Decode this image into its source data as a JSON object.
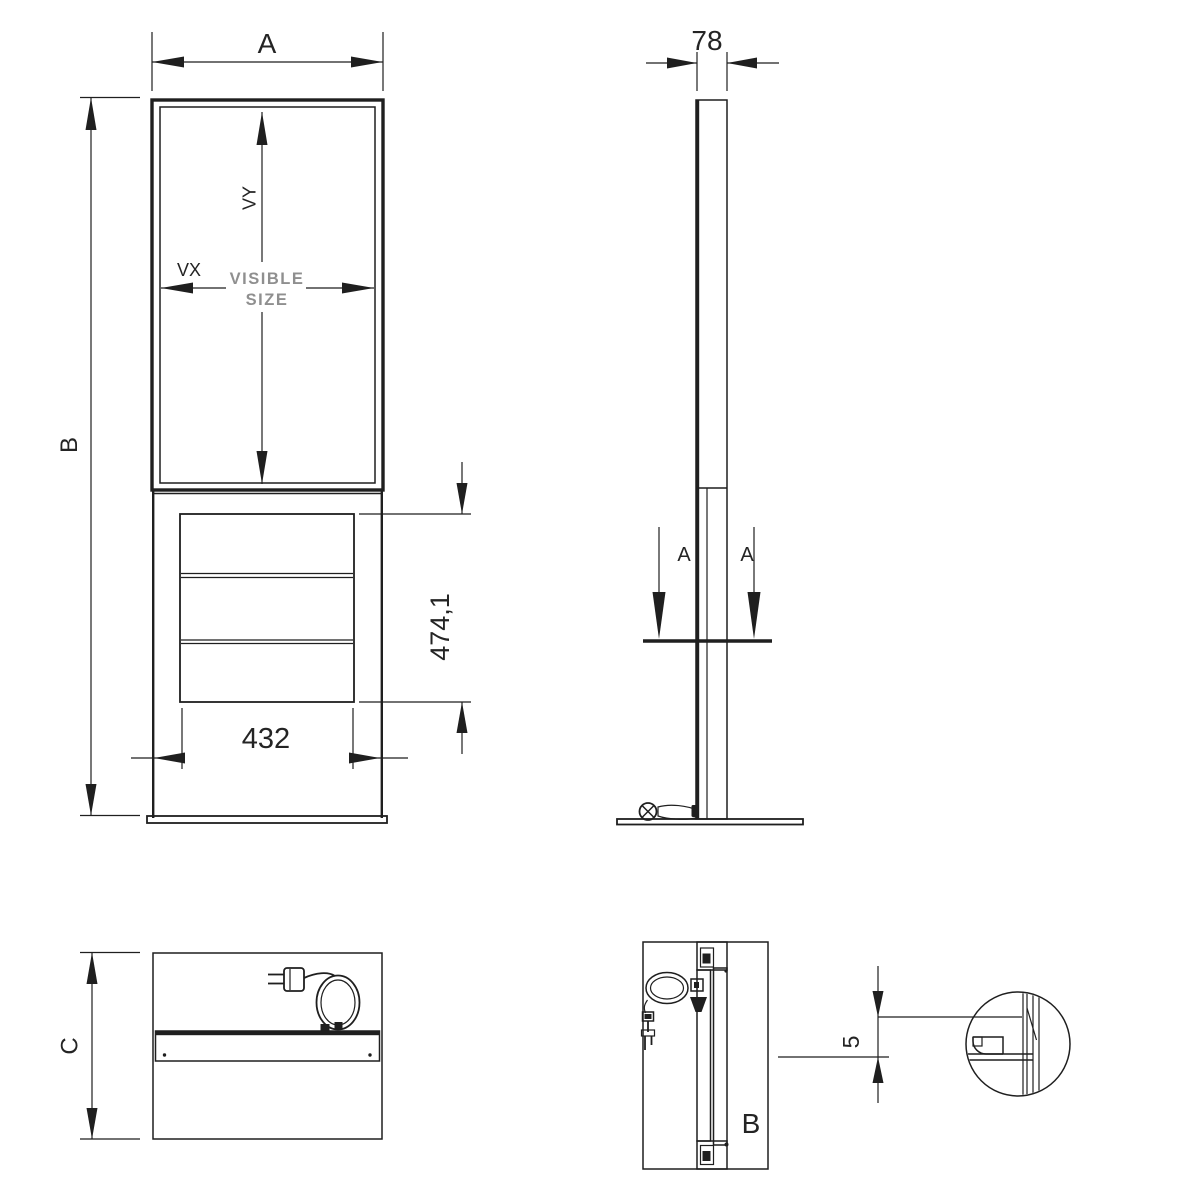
{
  "front_view": {
    "width_label": "A",
    "height_label": "B",
    "visible_height_label": "VY",
    "visible_width_label": "VX",
    "visible_size_text_line1": "VISIBLE",
    "visible_size_text_line2": "SIZE",
    "vent_panel_width": "432",
    "vent_panel_height": "474,1"
  },
  "side_view": {
    "depth": "78",
    "section_cut_label_left": "A",
    "section_cut_label_right": "A"
  },
  "base_top_view": {
    "depth_label": "C"
  },
  "section_view": {
    "view_label": "B",
    "foot_gap": "5"
  },
  "colors": {
    "line": "#1f1f1f",
    "muted_text": "#8f8f8f",
    "background": "#ffffff"
  }
}
